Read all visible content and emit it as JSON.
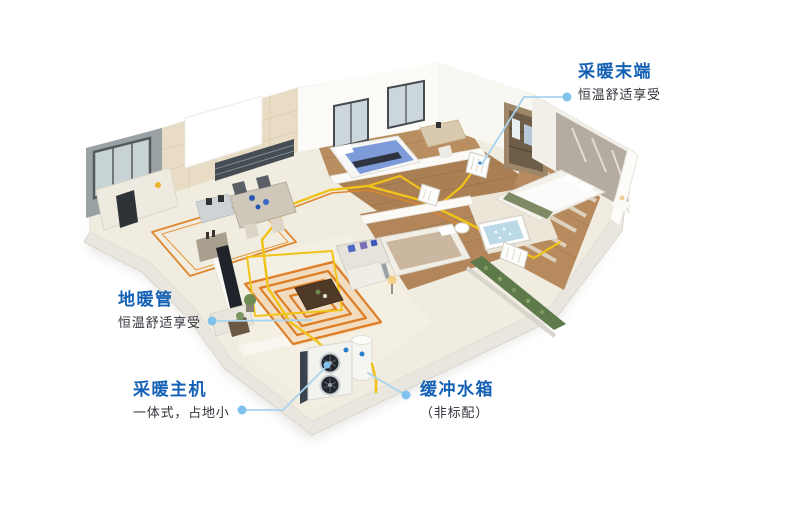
{
  "callouts": [
    {
      "title": "采暖末端",
      "subtitle": "恒温舒适享受"
    },
    {
      "title": "地暖管",
      "subtitle": "恒温舒适享受"
    },
    {
      "title": "采暖主机",
      "subtitle": "一体式，占地小"
    },
    {
      "title": "缓冲水箱",
      "subtitle": "（非标配）"
    }
  ],
  "colors": {
    "accent_blue": "#1360b4",
    "subtitle_text": "#30333a",
    "leader_line": "#a8d4ef",
    "callout_dot": "#7fc2ec",
    "pipe_yellow": "#f1c218",
    "pipe_orange": "#dd7d26",
    "wood_floor": "#b78b5e",
    "slab_cream": "#f1ece0"
  }
}
